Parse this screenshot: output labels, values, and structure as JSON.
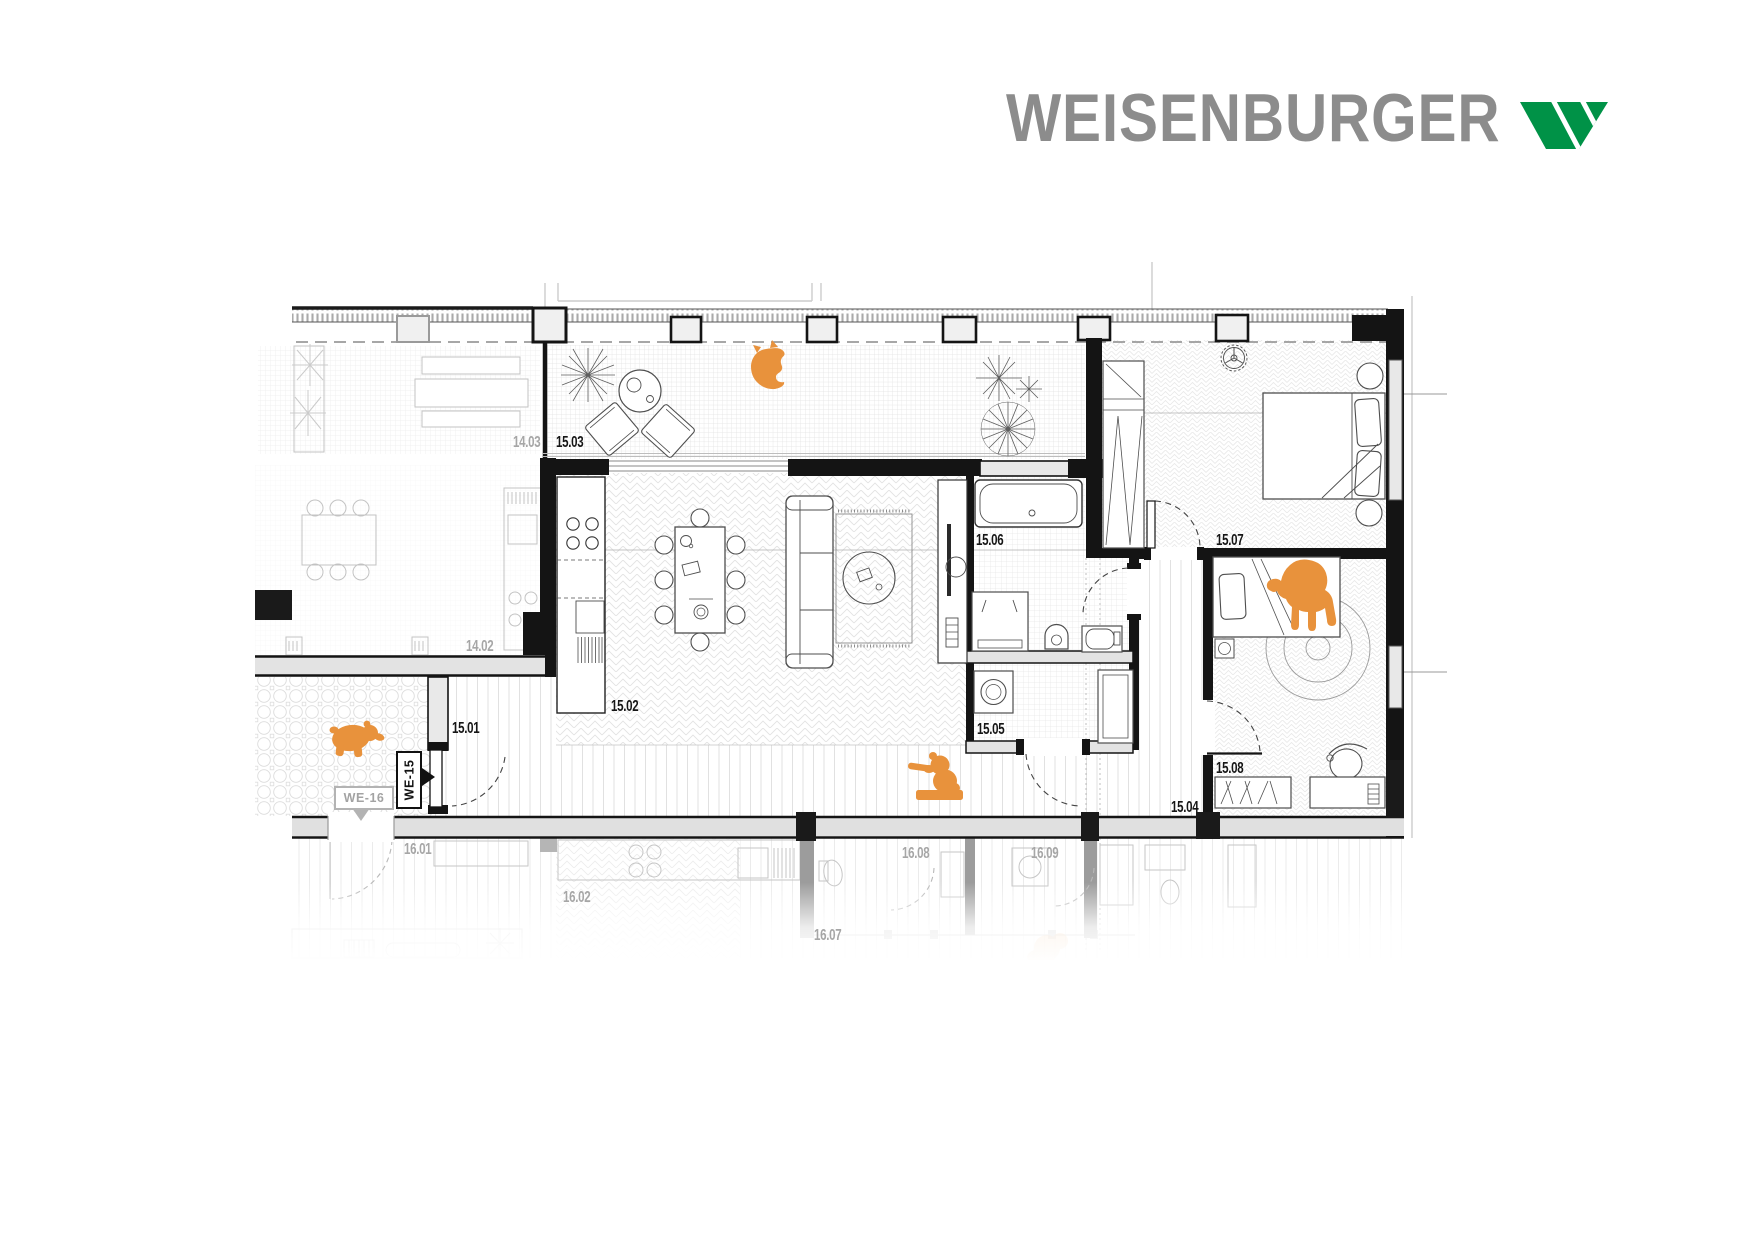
{
  "brand": {
    "name": "WEISENBURGER"
  },
  "plan": {
    "unit_tags": {
      "active": "WE-15",
      "neighbor": "WE-16"
    },
    "active_rooms": [
      {
        "id": "15.01",
        "x": 452,
        "y": 721
      },
      {
        "id": "15.02",
        "x": 611,
        "y": 699
      },
      {
        "id": "15.03",
        "x": 556,
        "y": 435
      },
      {
        "id": "15.04",
        "x": 1171,
        "y": 800
      },
      {
        "id": "15.05",
        "x": 977,
        "y": 722
      },
      {
        "id": "15.06",
        "x": 976,
        "y": 533
      },
      {
        "id": "15.07",
        "x": 1216,
        "y": 533
      },
      {
        "id": "15.08",
        "x": 1216,
        "y": 761
      }
    ],
    "neighbor_rooms": [
      {
        "id": "14.02",
        "x": 466,
        "y": 639
      },
      {
        "id": "14.03",
        "x": 513,
        "y": 435
      },
      {
        "id": "16.01",
        "x": 404,
        "y": 842
      },
      {
        "id": "16.02",
        "x": 563,
        "y": 890
      },
      {
        "id": "16.07",
        "x": 814,
        "y": 928
      },
      {
        "id": "16.08",
        "x": 902,
        "y": 846
      },
      {
        "id": "16.09",
        "x": 1031,
        "y": 846
      }
    ]
  },
  "colors": {
    "accent_orange": "#E8923C",
    "brand_green": "#009247",
    "logo_gray": "#8c8c8c",
    "active_line": "#151515",
    "muted_line": "#c3c3c3",
    "wall_fill": "#e5e5e5"
  }
}
